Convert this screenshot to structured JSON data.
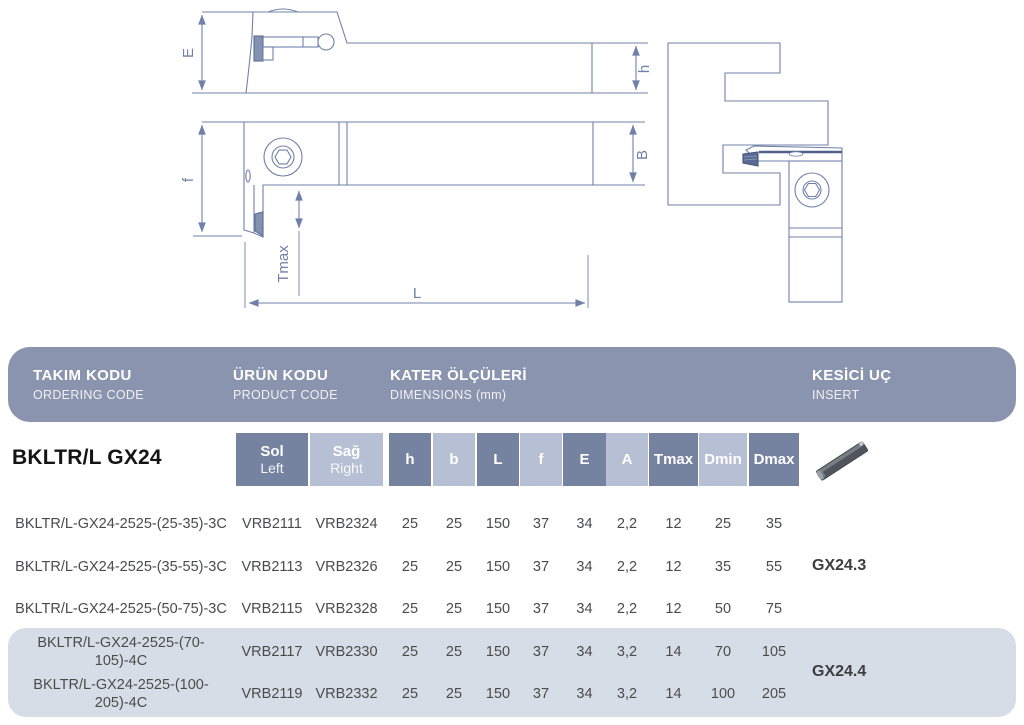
{
  "header": {
    "bg_color": "#8A94AE",
    "cols": [
      {
        "title": "TAKIM KODU",
        "subtitle": "ORDERING CODE"
      },
      {
        "title": "ÜRÜN KODU",
        "subtitle": "PRODUCT CODE"
      },
      {
        "title": "KATER ÖLÇÜLERİ",
        "subtitle": "DIMENSIONS (mm)"
      },
      {
        "title": "KESİCİ UÇ",
        "subtitle": "INSERT"
      }
    ]
  },
  "drawings": {
    "line_color": "#7080A8",
    "dim_labels": {
      "E": "E",
      "h": "h",
      "f": "f",
      "B": "B",
      "Tmax": "Tmax",
      "L": "L"
    }
  },
  "table": {
    "series_title": "BKLTR/L GX24",
    "col_sol_tr": "Sol",
    "col_sol_en": "Left",
    "col_sag_tr": "Sağ",
    "col_sag_en": "Right",
    "dim_cols": [
      "h",
      "b",
      "L",
      "f",
      "E",
      "A",
      "Tmax",
      "Dmin",
      "Dmax"
    ],
    "colors": {
      "dark_cell": "#7583A1",
      "light_cell": "#B6BFD3",
      "highlight_row_bg": "#D6DDE6"
    },
    "rows": [
      {
        "code": "BKLTR/L-GX24-2525-(25-35)-3C",
        "sol": "VRB2111",
        "sag": "VRB2324",
        "h": "25",
        "b": "25",
        "L": "150",
        "f": "37",
        "E": "34",
        "A": "2,2",
        "Tmax": "12",
        "Dmin": "25",
        "Dmax": "35",
        "highlighted": false
      },
      {
        "code": "BKLTR/L-GX24-2525-(35-55)-3C",
        "sol": "VRB2113",
        "sag": "VRB2326",
        "h": "25",
        "b": "25",
        "L": "150",
        "f": "37",
        "E": "34",
        "A": "2,2",
        "Tmax": "12",
        "Dmin": "35",
        "Dmax": "55",
        "highlighted": false
      },
      {
        "code": "BKLTR/L-GX24-2525-(50-75)-3C",
        "sol": "VRB2115",
        "sag": "VRB2328",
        "h": "25",
        "b": "25",
        "L": "150",
        "f": "37",
        "E": "34",
        "A": "2,2",
        "Tmax": "12",
        "Dmin": "50",
        "Dmax": "75",
        "highlighted": false
      },
      {
        "code": "BKLTR/L-GX24-2525-(70-105)-4C",
        "sol": "VRB2117",
        "sag": "VRB2330",
        "h": "25",
        "b": "25",
        "L": "150",
        "f": "37",
        "E": "34",
        "A": "3,2",
        "Tmax": "14",
        "Dmin": "70",
        "Dmax": "105",
        "highlighted": true
      },
      {
        "code": "BKLTR/L-GX24-2525-(100-205)-4C",
        "sol": "VRB2119",
        "sag": "VRB2332",
        "h": "25",
        "b": "25",
        "L": "150",
        "f": "37",
        "E": "34",
        "A": "3,2",
        "Tmax": "14",
        "Dmin": "100",
        "Dmax": "205",
        "highlighted": true
      }
    ],
    "insert_groups": [
      {
        "label": "GX24.3"
      },
      {
        "label": "GX24.4"
      }
    ]
  }
}
